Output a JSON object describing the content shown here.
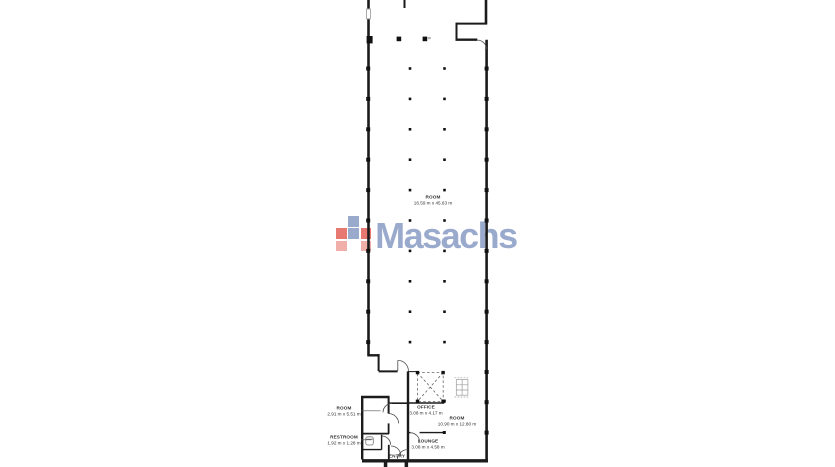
{
  "watermark": {
    "brand": "Masachs",
    "brand_color": "#8d9fc7",
    "squares": [
      {
        "row": 0,
        "col": 1,
        "color": "#8d9fc7"
      },
      {
        "row": 1,
        "col": 0,
        "color": "#e4675f"
      },
      {
        "row": 1,
        "col": 1,
        "color": "#8d9fc7"
      },
      {
        "row": 1,
        "col": 2,
        "color": "#e4675f"
      },
      {
        "row": 2,
        "col": 0,
        "color": "#efa49e"
      },
      {
        "row": 2,
        "col": 2,
        "color": "#efa49e"
      }
    ]
  },
  "plan": {
    "wall_color": "#1b1b1b",
    "rooms": [
      {
        "id": "main-room",
        "name": "ROOM",
        "dims": "16.59 m x 45.63 m"
      },
      {
        "id": "room-left",
        "name": "ROOM",
        "dims": "2.91 m x 5.51 m"
      },
      {
        "id": "office",
        "name": "OFFICE",
        "dims": "3.08 m x 4.17 m"
      },
      {
        "id": "room-right",
        "name": "ROOM",
        "dims": "10.90 m x 12.80 m"
      },
      {
        "id": "restroom",
        "name": "RESTROOM",
        "dims": "1.92 m x 1.28 m"
      },
      {
        "id": "lounge",
        "name": "LOUNGE",
        "dims": "3.08 m x 4.58 m"
      },
      {
        "id": "entry",
        "name": "ENTRY",
        "dims": ""
      }
    ]
  }
}
